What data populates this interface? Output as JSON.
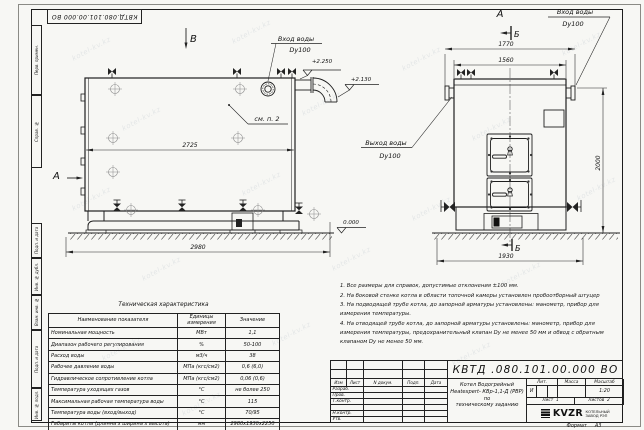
{
  "watermark": "kotel-kv.kz",
  "sheet": {
    "top_stamp": "КВТД.080.101.00.000 ВО",
    "format_label": "Формат",
    "format_value": "А3",
    "left_stamps": {
      "s1": "Перв. примен.",
      "s2": "Справ. №",
      "s3": "Подп. и дата",
      "s4": "Инв. № дубл.",
      "s5": "Взам. инв. №",
      "s6": "Подп. и дата",
      "s7": "Инв. № подл."
    }
  },
  "side_view": {
    "label_top": "В",
    "label_left": "А",
    "inlet_title": "Вход воды",
    "inlet_dn": "Dy100",
    "note_ref": "см. п. 2",
    "dim_width_inner": "2725",
    "dim_width_overall": "2980",
    "elev_top": "+2.250",
    "elev_flue": "+2.130",
    "elev_zero": "0.000"
  },
  "front_view": {
    "label_top": "А",
    "section_top": "Б",
    "section_bottom": "Б",
    "inlet_title": "Вход воды",
    "inlet_dn": "Dy100",
    "outlet_title": "Выход воды",
    "outlet_dn": "Dy100",
    "dim_overall_width": "1770",
    "dim_body_width": "1560",
    "dim_height": "2000",
    "dim_base_width": "1930"
  },
  "notes": {
    "n1": "1. Все размеры для справок, допустимые отклонения ±100 мм.",
    "n2": "2. На боковой стенке котла в области топочной камеры установлен пробоотборный штуцер",
    "n3": "3. На подводящей трубе котла, до запорной арматуры установлены: манометр, прибор для измерения температуры.",
    "n4": "4. На отводящей трубе котла, до запорной арматуры установлены: манометр, прибор для измерения температуры, предохранительный клапан Dу не менее 50 мм и обвод с обратным клапаном Dу не менее 50 мм."
  },
  "tech_table": {
    "title": "Техническая характеристика",
    "col_name": "Наименование показателя",
    "col_units": "Единицы измерения",
    "col_value": "Значение",
    "rows": [
      {
        "name": "Номинальная мощность",
        "units": "МВт",
        "value": "1,1"
      },
      {
        "name": "Диапазон рабочего регулирования",
        "units": "%",
        "value": "50-100"
      },
      {
        "name": "Расход воды",
        "units": "м3/ч",
        "value": "38"
      },
      {
        "name": "Рабочее давление воды",
        "units": "МПа (кгс/см2)",
        "value": "0,6 (6,0)"
      },
      {
        "name": "Гидравлическое сопротивление котла",
        "units": "МПа (кгс/см2)",
        "value": "0,06 (0,6)"
      },
      {
        "name": "Температура уходящих газов",
        "units": "°С",
        "value": "не более 250"
      },
      {
        "name": "Максимальная рабочая температура воды",
        "units": "°С",
        "value": "115"
      },
      {
        "name": "Температура воды (вход/выход)",
        "units": "°С",
        "value": "70/95"
      },
      {
        "name": "Габариты котла (длинна х ширина х высота)",
        "units": "мм",
        "value": "2980х1930х2250"
      }
    ]
  },
  "title_block": {
    "doc_number": "КВТД .080.101.00.000  ВО",
    "name_line1": "Котел Водогрейный",
    "name_line2": "Heatexpert- КВр-1,1-Д (РВР) по",
    "name_line3": "техническому заданию",
    "col_izm": "Изм",
    "col_list": "Лист",
    "col_doc": "N докум.",
    "col_sign": "Подп.",
    "col_date": "Дата",
    "row_developed": "Разраб.",
    "row_checked": "Пров.",
    "row_tcontrol": "Т.контр.",
    "row_ncontrol": "Н.контр.",
    "row_approved": "Утв.",
    "lit_header": "Лит.",
    "mass_header": "Масса",
    "scale_header": "Масштаб",
    "lit_value": "И",
    "scale_value": "1:20",
    "sheet_label": "Лист",
    "sheet_value": "1",
    "sheets_label": "Листов",
    "sheets_value": "2",
    "logo_text": "KVZR",
    "logo_sub1": "КОТЕЛЬНЫЙ",
    "logo_sub2": "ЗАВОД РЭП"
  }
}
